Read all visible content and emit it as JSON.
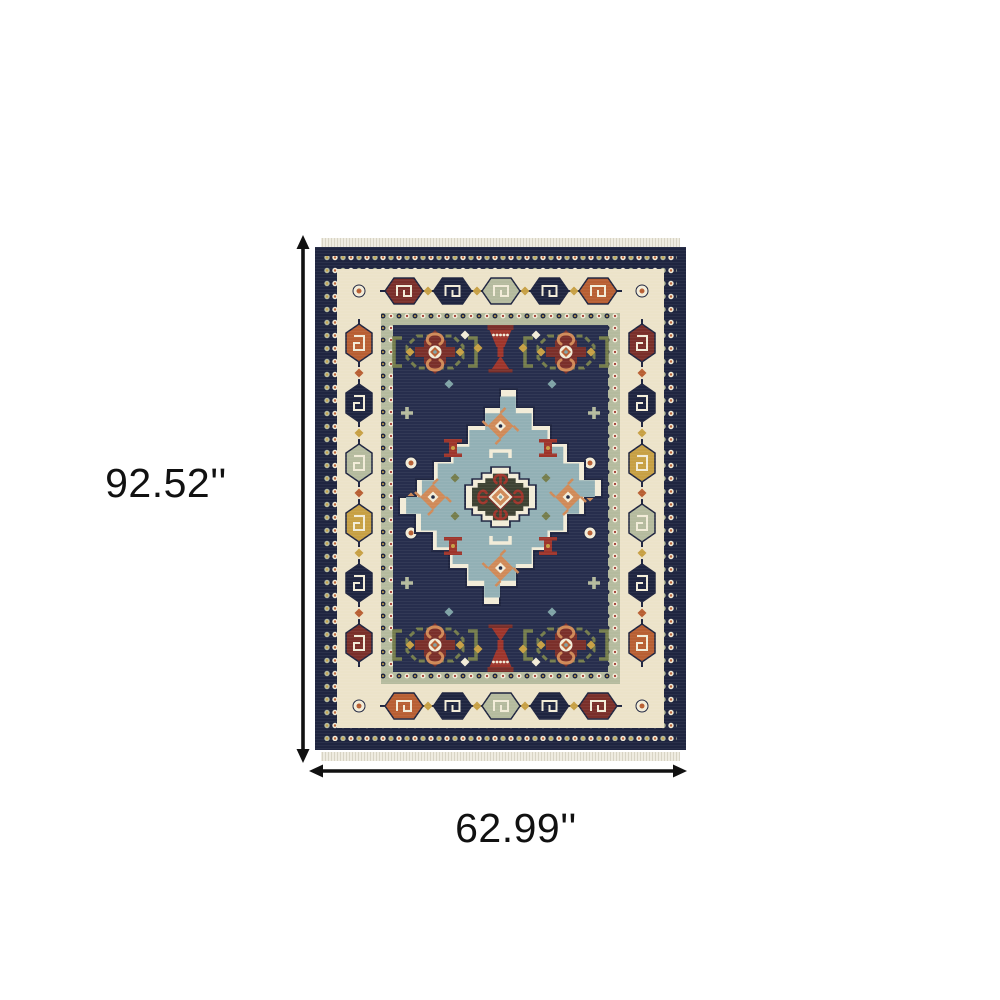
{
  "image": {
    "subject": "area-rug-top-view",
    "annotation_type": "product-dimensions"
  },
  "dimensions": {
    "height_label": "92.52''",
    "width_label": "62.99''"
  },
  "colors": {
    "background": "#ffffff",
    "label": "#111111",
    "navy": "#1f2540",
    "navy_field": "#272e4d",
    "ivory": "#ece3c9",
    "cream": "#f2ecd8",
    "sage": "#b5bb9e",
    "light_blue": "#92b0b5",
    "rust": "#b85f33",
    "salmon": "#d08a58",
    "maroon": "#7a2f2a",
    "red": "#9e352b",
    "gold": "#c7a044",
    "green": "#757d4c",
    "teal": "#7fa3a6",
    "dark_olive": "#3e4233",
    "fringe": "#efece1"
  }
}
